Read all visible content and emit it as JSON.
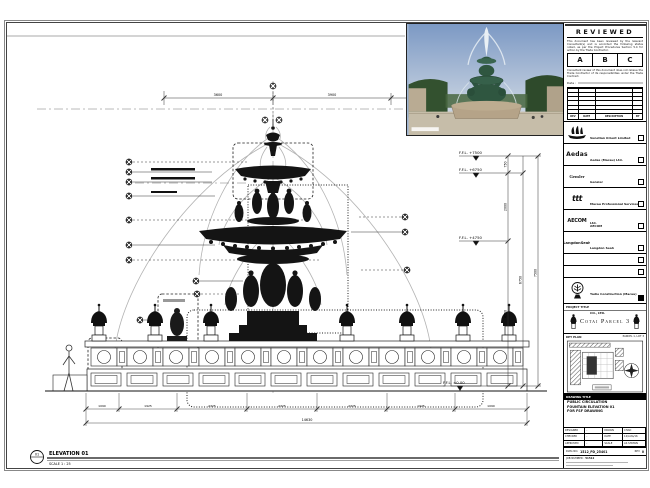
{
  "sheet": {
    "top_note": "DO NOT SCALE DRAWING. VERIFY ALL DIMENSIONS ON SITE."
  },
  "stamp": {
    "title": "REVIEWED",
    "para1": "This document has been reviewed by the relevant Consultant(s) and is accorded the following status noted, as per the Project Procedures Section 5.4 for action by the Trade Contractor.",
    "statuses": [
      "A",
      "B",
      "C"
    ],
    "para2": "Consultant review of this document does not relieve the Trade Contractor of its responsibilities under the Trade Contract.",
    "date_label": "Date :",
    "table_headers": [
      "REV",
      "DATE",
      "DESCRIPTION",
      "BY"
    ]
  },
  "consultants": [
    {
      "name": "Venetian Orient Limited",
      "logo": "ship"
    },
    {
      "name": "Aedas (Macau) Ltd.",
      "logo": "Aedas"
    },
    {
      "name": "Gensler",
      "logo": "Gensler"
    },
    {
      "name": "Macau Professional Services Ltd.",
      "logo": "ttt"
    },
    {
      "name": "AECOM",
      "logo": "AECOM"
    },
    {
      "name": "Langdon Seah",
      "logo": "LangdonSeah"
    }
  ],
  "contractor": {
    "name": "Yadie Construction (Macau) CO., LTD."
  },
  "project": {
    "header": "PROJECT TITLE",
    "title": "Cotai Parcel 3"
  },
  "key_plan": {
    "label": "KEY PLAN",
    "sublabel": "PARCEL 1, LOT 3"
  },
  "drawing_title": {
    "header": "DRAWING TITLE",
    "line1": "PUBLIC CIRCULATION",
    "line2": "FOUNTAIN ELEVATION 01",
    "line3": "FOR FSF DRAWING"
  },
  "info": {
    "r1l": "DESIGNED",
    "r1v": "-",
    "r1l2": "DRAWN",
    "r1v2": "CHAD",
    "r2l": "CHECKED",
    "r2v": "-",
    "r2l2": "DATE",
    "r2v2": "12/AUG/16",
    "r3l": "APPROVED",
    "r3v": "-",
    "r3l2": "SCALE",
    "r3v2": "AS SHOWN",
    "dwg_label": "DWG NO.",
    "dwg_no": "1512_PD_25401",
    "rev_label": "REV",
    "rev": "0",
    "job_label": "JOB NUMBER :",
    "job_no": "51512"
  },
  "annotations": {
    "elev_no": "01",
    "elev_label": "ELEVATION 01",
    "elev_scale": "SCALE  1 : 25",
    "levels": [
      "F.F.L. +7500",
      "F.F.L. +6750",
      "F.F.L. +4750",
      "F.F.L. ±0.00"
    ],
    "vdims": [
      "750",
      "2000",
      "4750",
      "6750",
      "7500"
    ],
    "top_dims": [
      "3600",
      "3900",
      "3600"
    ],
    "bottom_dims": [
      "1090",
      "1925",
      "2325",
      "2325",
      "2325",
      "1925",
      "1090"
    ],
    "bottom_total": "14630"
  }
}
